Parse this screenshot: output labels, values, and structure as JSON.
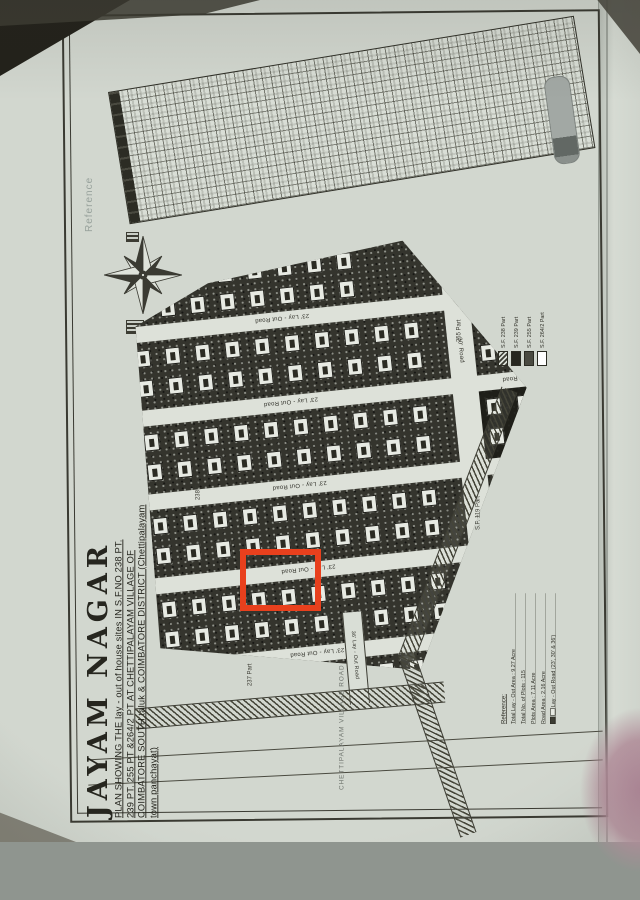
{
  "annotation": {
    "highlight_color": "#e8401d"
  },
  "title": {
    "name": "JAYAM NAGAR",
    "lines": [
      "PLAN SHOWING THE lay - out of house sites IN S.F.NO 238 PT.",
      "239 PT. 255 PT &264/2 PT AT CHETTIPALAYAM VILLAGE OF",
      "COIMBATORE SOUTH taluk & COIMBATORE DISTRICT (Chettipalayam",
      "town panchayat)"
    ]
  },
  "table": {
    "side_label": "Reference"
  },
  "roads": {
    "cross_road_label": "23' Lay - Out Road",
    "main_road_label": "30' Road",
    "lay36_label": "36' Lay - Out Road",
    "village_road_label": "CHETTIPALAYAM VILLAGE ROAD"
  },
  "boundary_labels": [
    "255 Part",
    "238 Part",
    "237 Part",
    "S.F. 119 Part"
  ],
  "legend": {
    "items": [
      {
        "label": "S.F. 238 Part",
        "fill": "hatch"
      },
      {
        "label": "S.F. 239 Part",
        "fill": "#26261f"
      },
      {
        "label": "S.F. 255 Part",
        "fill": "#4a4a41"
      },
      {
        "label": "S.F. 264/2 Part",
        "fill": "#ffffff"
      }
    ]
  },
  "reference_block": {
    "heading": "Reference:",
    "lines": [
      "Total Lay - Out Area : 9.27 Acre",
      "Total No. of Plots : 115",
      "Plots Area : 7.11 Acre",
      "Road Area : 2.16 Acre",
      "Lay - Out Road (23', 30' & 36')"
    ]
  },
  "plan": {
    "bands": [
      {
        "left_cols": 7,
        "right_cols": 3
      },
      {
        "left_cols": 10,
        "right_cols": 3
      },
      {
        "left_cols": 10,
        "right_cols": 3
      },
      {
        "left_cols": 10,
        "right_cols": 3
      },
      {
        "left_cols": 10,
        "right_cols": 3
      },
      {
        "left_cols": 9,
        "right_cols": 0
      }
    ]
  }
}
